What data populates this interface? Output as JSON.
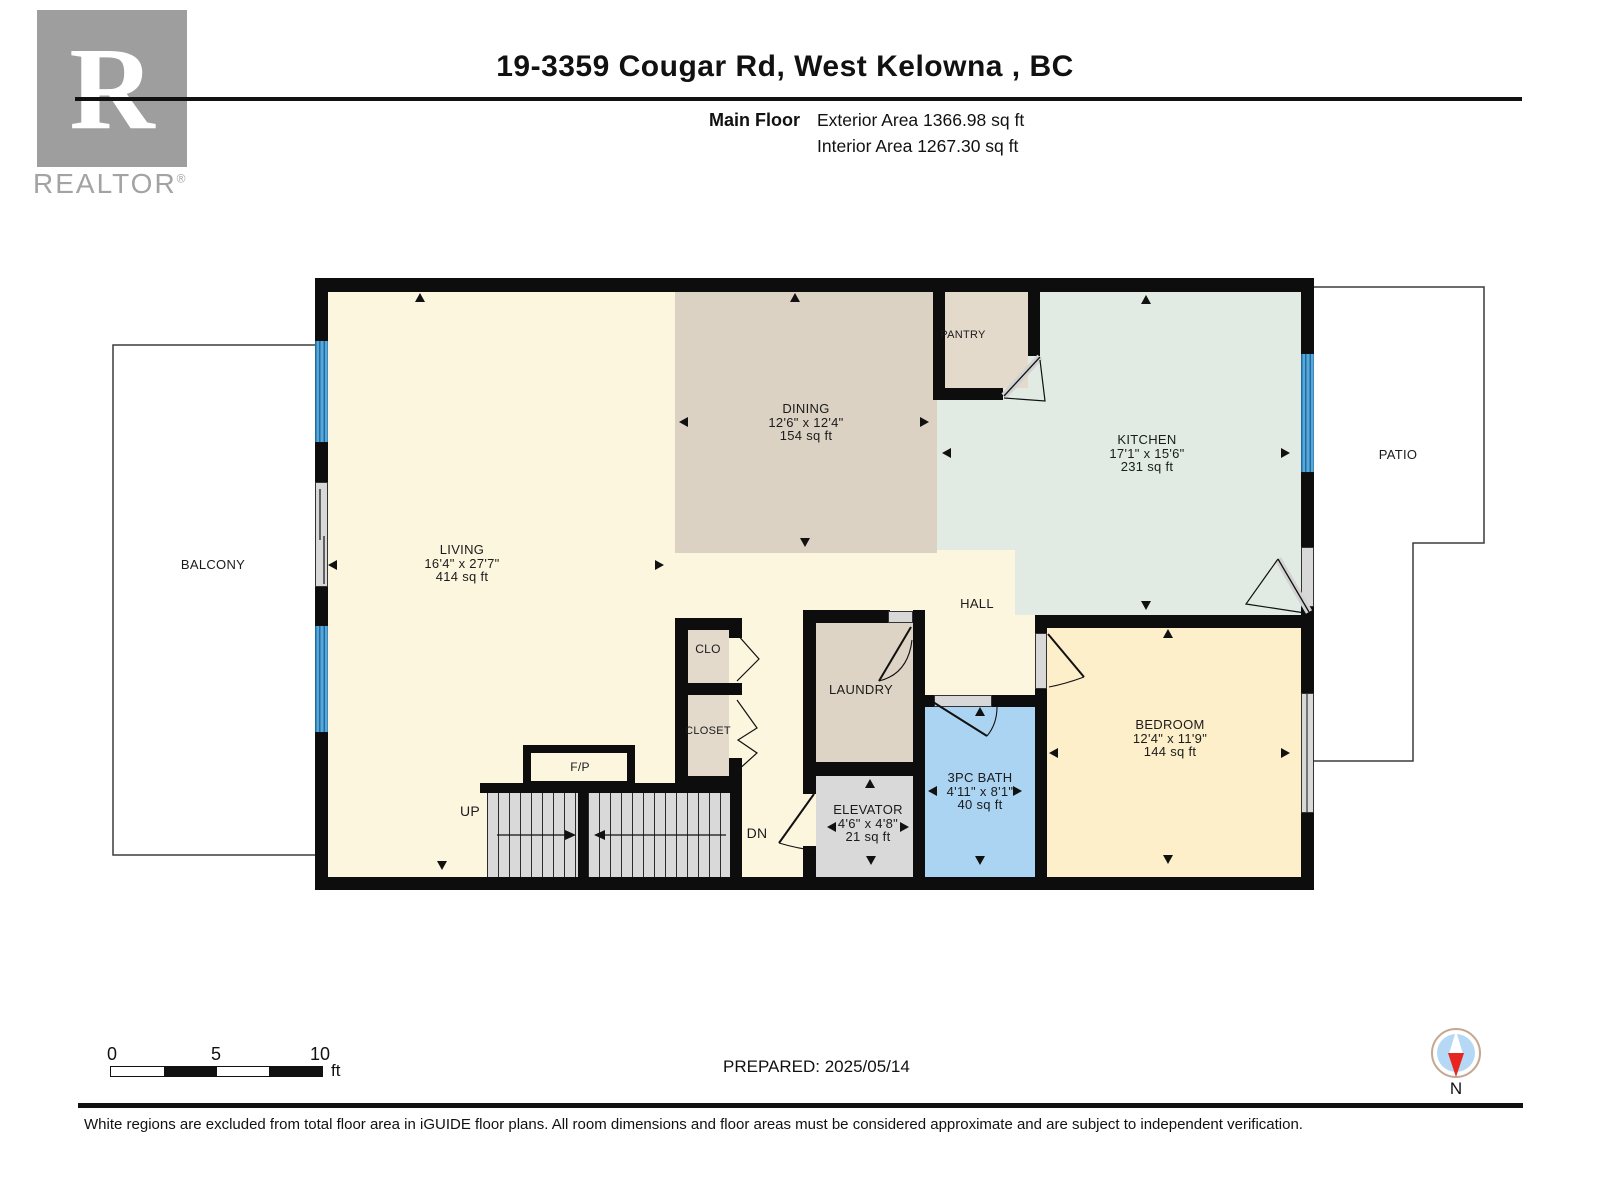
{
  "header": {
    "title": "19-3359 Cougar Rd, West Kelowna , BC",
    "floor_label": "Main Floor",
    "exterior_area": "Exterior Area 1366.98 sq ft",
    "interior_area": "Interior Area 1267.30 sq ft"
  },
  "branding": {
    "logo_letter": "R",
    "logo_name": "REALTOR",
    "registered_mark": "®"
  },
  "rooms": {
    "living": {
      "name": "LIVING",
      "dims": "16'4\" x 27'7\"",
      "area": "414 sq ft"
    },
    "dining": {
      "name": "DINING",
      "dims": "12'6\" x 12'4\"",
      "area": "154 sq ft"
    },
    "kitchen": {
      "name": "KITCHEN",
      "dims": "17'1\" x 15'6\"",
      "area": "231 sq ft"
    },
    "bedroom": {
      "name": "BEDROOM",
      "dims": "12'4\" x 11'9\"",
      "area": "144 sq ft"
    },
    "bath": {
      "name": "3PC BATH",
      "dims": "4'11\" x 8'1\"",
      "area": "40 sq ft"
    },
    "elevator": {
      "name": "ELEVATOR",
      "dims": "4'6\" x 4'8\"",
      "area": "21 sq ft"
    },
    "laundry": {
      "name": "LAUNDRY"
    },
    "pantry": {
      "name": "PANTRY"
    },
    "hall": {
      "name": "HALL"
    },
    "clo": {
      "name": "CLO"
    },
    "closet": {
      "name": "CLOSET"
    },
    "balcony": {
      "name": "BALCONY"
    },
    "patio": {
      "name": "PATIO"
    },
    "fireplace": {
      "name": "F/P"
    }
  },
  "stairs": {
    "up_label": "UP",
    "down_label": "DN"
  },
  "scale_bar": {
    "tick_0": "0",
    "tick_5": "5",
    "tick_10": "10",
    "unit": "ft"
  },
  "footer": {
    "prepared": "PREPARED: 2025/05/14",
    "compass_north": "N",
    "disclaimer": "White regions are excluded from total floor area in iGUIDE floor plans. All room dimensions and floor areas must be considered approximate and are subject to independent verification."
  },
  "colors": {
    "wall": "#0d0d0d",
    "living_cream": "#fdf6df",
    "dining_beige": "#dbd2c3",
    "kitchen_mint": "#e1ebe4",
    "bedroom_yellow": "#fcefc9",
    "bath_blue": "#abd4f2",
    "gray": "#d9d9d9",
    "window_blue": "#58a7d8",
    "compass_red": "#e8251f"
  }
}
